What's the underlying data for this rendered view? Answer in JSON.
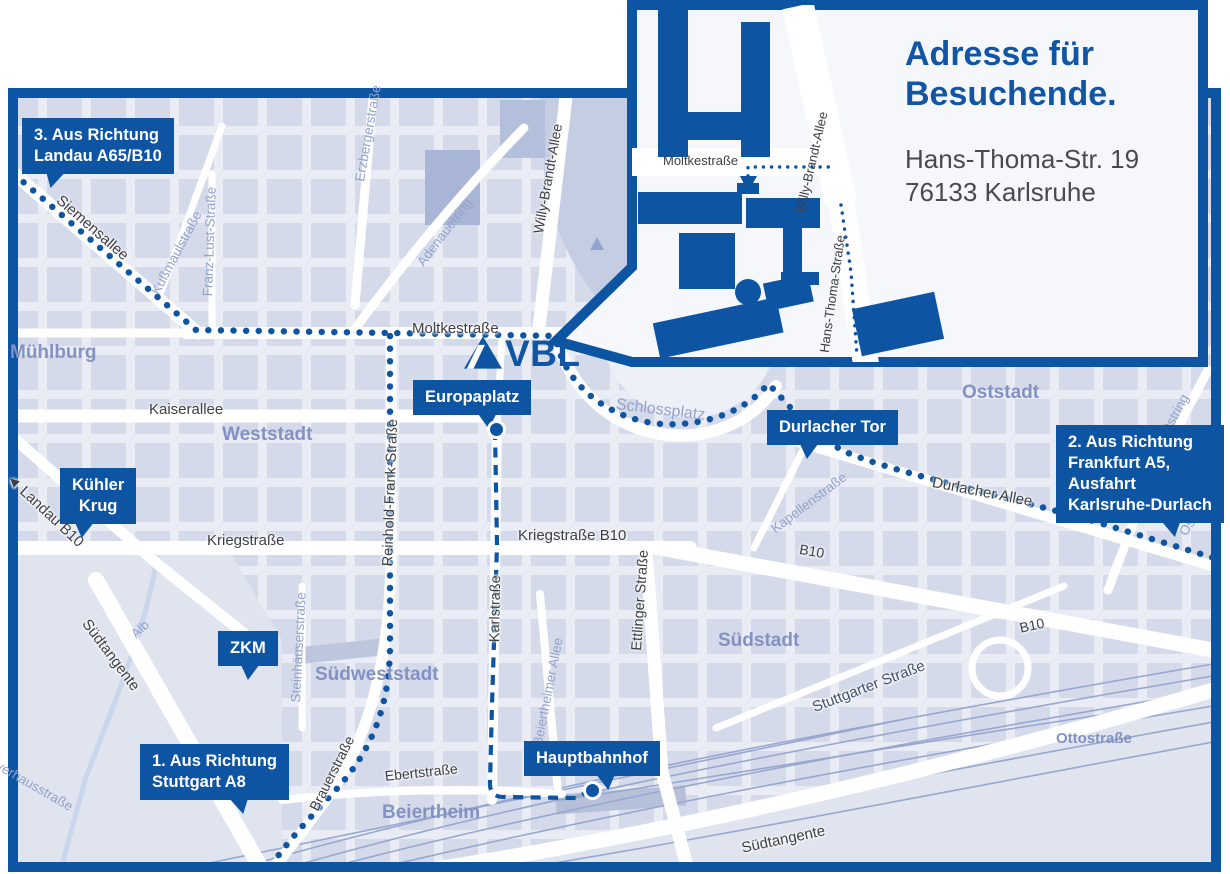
{
  "colors": {
    "primary_blue": "#0d55a3",
    "logo_blue": "#1156a5",
    "map_background": "#e9ecf4",
    "building_block": "#cdd4e6",
    "park": "#c4cde1",
    "district_text": "#8292c3",
    "street_text": "#3f4043",
    "minor_street_text": "#93a2cc",
    "inset_background": "#f5f7fb",
    "address_text": "#4a4a4c"
  },
  "logo": {
    "text": "VBL"
  },
  "inset": {
    "title": "Adresse für\nBesuchende.",
    "address": "Hans-Thoma-Str. 19\n76133 Karlsruhe",
    "streets": {
      "moltkestrasse": "Moltkestraße",
      "willy_brandt_allee": "Willy-Brandt-Allee",
      "hans_thoma_strasse": "Hans-Thoma-Straße"
    }
  },
  "markers": {
    "landau": "3. Aus Richtung\nLandau A65/B10",
    "kuehler_krug": "Kühler\nKrug",
    "zkm": "ZKM",
    "stuttgart": "1. Aus Richtung\nStuttgart A8",
    "europaplatz": "Europaplatz",
    "durlacher_tor": "Durlacher Tor",
    "hauptbahnhof": "Hauptbahnhof",
    "frankfurt": "2. Aus Richtung\nFrankfurt A5,\nAusfahrt\nKarlsruhe-Durlach"
  },
  "streets": {
    "siemensallee": "Siemensallee",
    "kussmaulstrasse": "Kußmaulstraße",
    "franz_lust_strasse": "Franz-Lust-Straße",
    "erzbergerstrasse": "Erzbergerstraße",
    "adenauerring": "Adenauerring",
    "willy_brandt_allee": "Willy-Brandt-Allee",
    "moltkestrasse": "Moltkestraße",
    "kaiserallee": "Kaiserallee",
    "reinhold_frank_strasse": "Reinhold-Frank-Straße",
    "kriegstrasse": "Kriegstraße",
    "kriegstrasse_b10": "Kriegstraße B10",
    "karlstrasse": "Karlstraße",
    "ettlinger_strasse": "Ettlinger Straße",
    "kapellenstrasse": "Kapellenstraße",
    "durlacher_allee": "Durlacher Allee",
    "b10_east": "B10",
    "b10_southeast": "B10",
    "landau_b10": "Landau B10",
    "steinhaeuserstrasse": "Steinhäuserstraße",
    "brauerstrasse": "Brauerstraße",
    "ebertstrasse": "Ebertstraße",
    "beiertheimer_allee": "Beiertheimer Allee",
    "suedtangente_west": "Südtangente",
    "suedtangente_east": "Südtangente",
    "stuttgarter_strasse": "Stuttgarter Straße",
    "ottostrasse": "Ottostraße",
    "pulverhausstrasse": "Pulverhausstraße",
    "ostring": "Ostring",
    "alb": "Alb",
    "schlossplatz": "Schlossplatz"
  },
  "districts": {
    "muehlburg": "Mühlburg",
    "weststadt": "Weststadt",
    "oststadt": "Oststadt",
    "suedweststadt": "Südweststadt",
    "suedstadt": "Südstadt",
    "beiertheim": "Beiertheim"
  }
}
